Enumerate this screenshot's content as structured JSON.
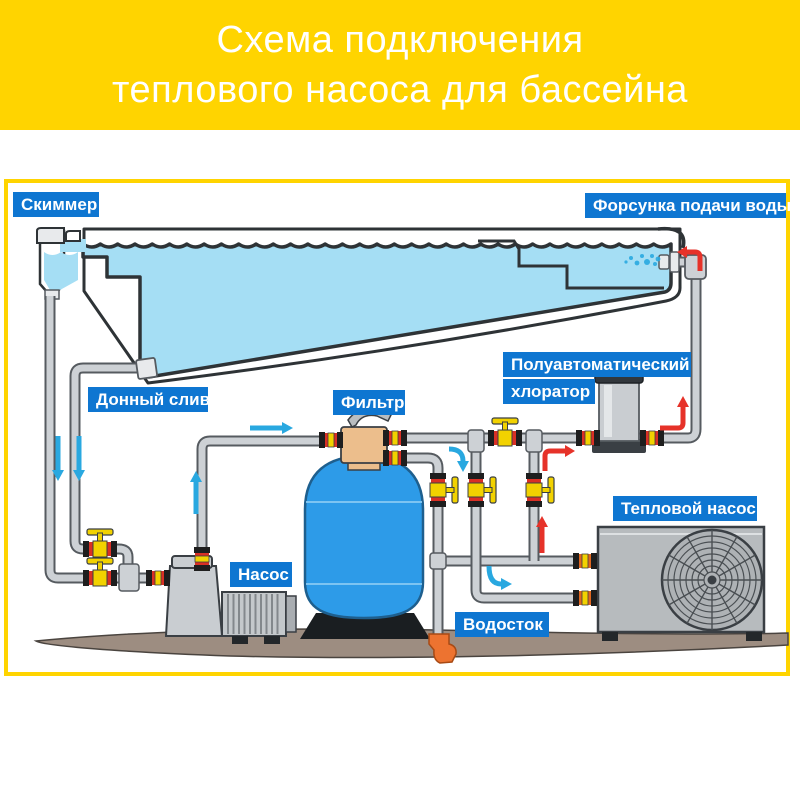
{
  "title": {
    "line1": "Схема подключения",
    "line2": "теплового насоса для бассейна"
  },
  "labels": {
    "skimmer": "Скиммер",
    "inlet_nozzle": "Форсунка подачи воды",
    "bottom_drain": "Донный слив",
    "filter": "Фильтр",
    "chlorinator_line1": "Полуавтоматический",
    "chlorinator_line2": "хлоратор",
    "pump": "Насос",
    "heat_pump": "Тепловой насос",
    "drain": "Водосток"
  },
  "colors": {
    "header_bg": "#FFD400",
    "frame_border": "#FFD400",
    "label_bg": "#0E76D1",
    "label_text": "#FFFFFF",
    "water": "#A5DEF4",
    "tank_blue": "#2D9BE8",
    "tank_seam": "#7CC4F2",
    "pipe": "#CDD1D5",
    "pipe_edge": "#565B60",
    "valve_yellow": "#F2D200",
    "valve_red": "#D93025",
    "valve_dark": "#1E1E1E",
    "union_orange": "#E0661F",
    "arrow_blue": "#29A8E0",
    "arrow_red": "#E63229",
    "ground": "#9D8D81",
    "ground_edge": "#4A443F",
    "drain_orange": "#ED7330",
    "metal": "#C9CDD1",
    "hp_gray": "#B7BBBE",
    "outline": "#2E3336"
  }
}
